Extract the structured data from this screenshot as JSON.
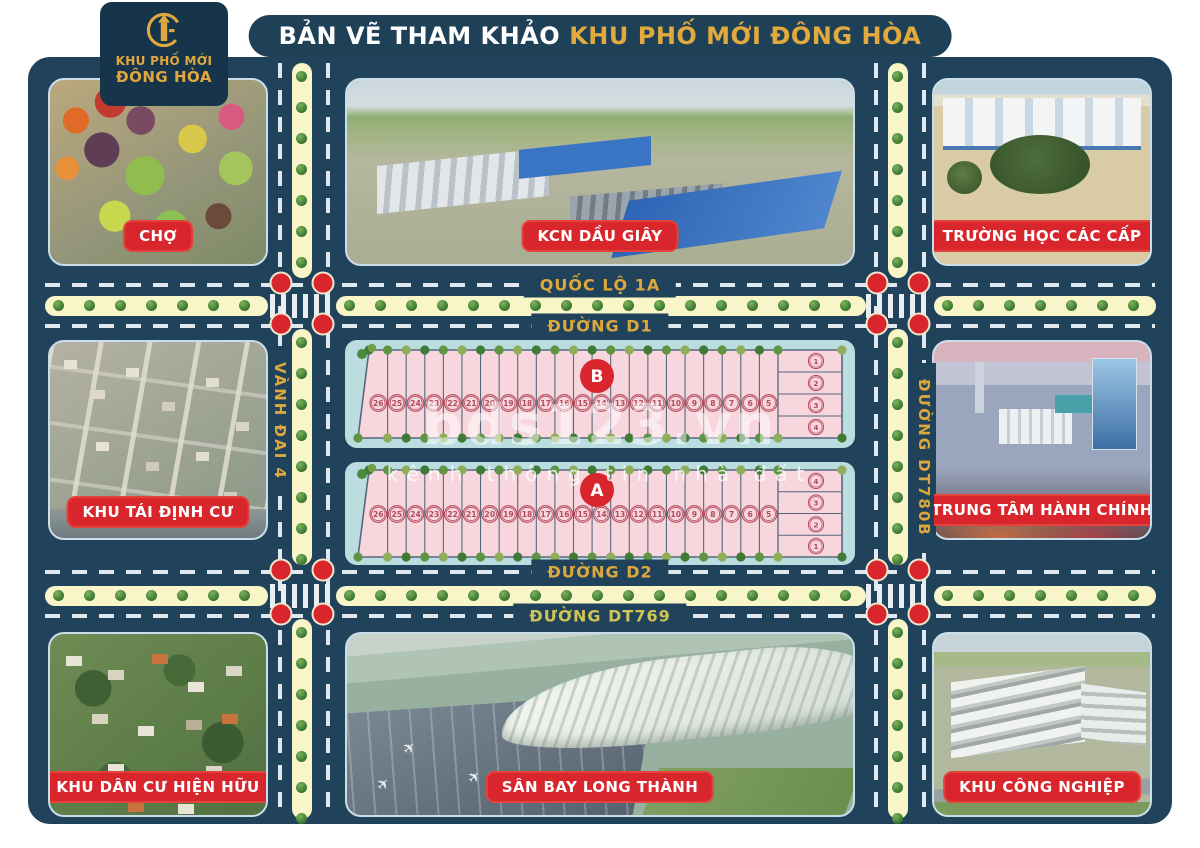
{
  "header": {
    "title_prefix": "BẢN VẼ THAM KHẢO",
    "title_highlight": "KHU PHỐ MỚI ĐÔNG HÒA",
    "logo_line1": "KHU PHỐ MỚI",
    "logo_line2": "ĐÔNG HÒA"
  },
  "roads": {
    "quoc_lo_1a": "QUỐC LỘ 1A",
    "duong_d1": "ĐƯỜNG D1",
    "duong_d2": "ĐƯỜNG D2",
    "duong_dt769": "ĐƯỜNG DT769",
    "vanh_dai_4": "VÀNH ĐAI 4",
    "duong_dt780b": "ĐƯỜNG DT780B"
  },
  "locations": {
    "market": "CHỢ",
    "kcn_dau_giay": "KCN DẦU GIÂY",
    "school": "TRƯỜNG HỌC CÁC CẤP",
    "resettlement": "KHU TÁI ĐỊNH CƯ",
    "admin_center": "TRUNG TÂM HÀNH CHÍNH",
    "residential": "KHU DÂN CƯ HIỆN HỮU",
    "airport": "SÂN BAY LONG THÀNH",
    "industrial": "KHU CÔNG NGHIỆP"
  },
  "blocks": [
    {
      "id": "B",
      "lots": [
        26,
        25,
        24,
        23,
        22,
        21,
        20,
        19,
        18,
        17,
        16,
        15,
        14,
        13,
        12,
        11,
        10,
        9,
        8,
        7,
        6,
        5
      ],
      "side_lots": [
        1,
        2,
        3,
        4
      ]
    },
    {
      "id": "A",
      "lots": [
        26,
        25,
        24,
        23,
        22,
        21,
        20,
        19,
        18,
        17,
        16,
        15,
        14,
        13,
        12,
        11,
        10,
        9,
        8,
        7,
        6,
        5
      ],
      "side_lots": [
        4,
        3,
        2,
        1
      ]
    }
  ],
  "watermark": {
    "brand": "bds123.vn",
    "tagline": "kênh thông tin nhà đất"
  },
  "colors": {
    "navy": "#20425A",
    "gold": "#E0A83E",
    "red": "#D8262C",
    "road_cream": "#F8F5C8",
    "block_teal": "#BBDDE0",
    "lot_pink": "#F7D6DD",
    "lot_line": "#56697B",
    "lot_num": "#B34A5B"
  }
}
